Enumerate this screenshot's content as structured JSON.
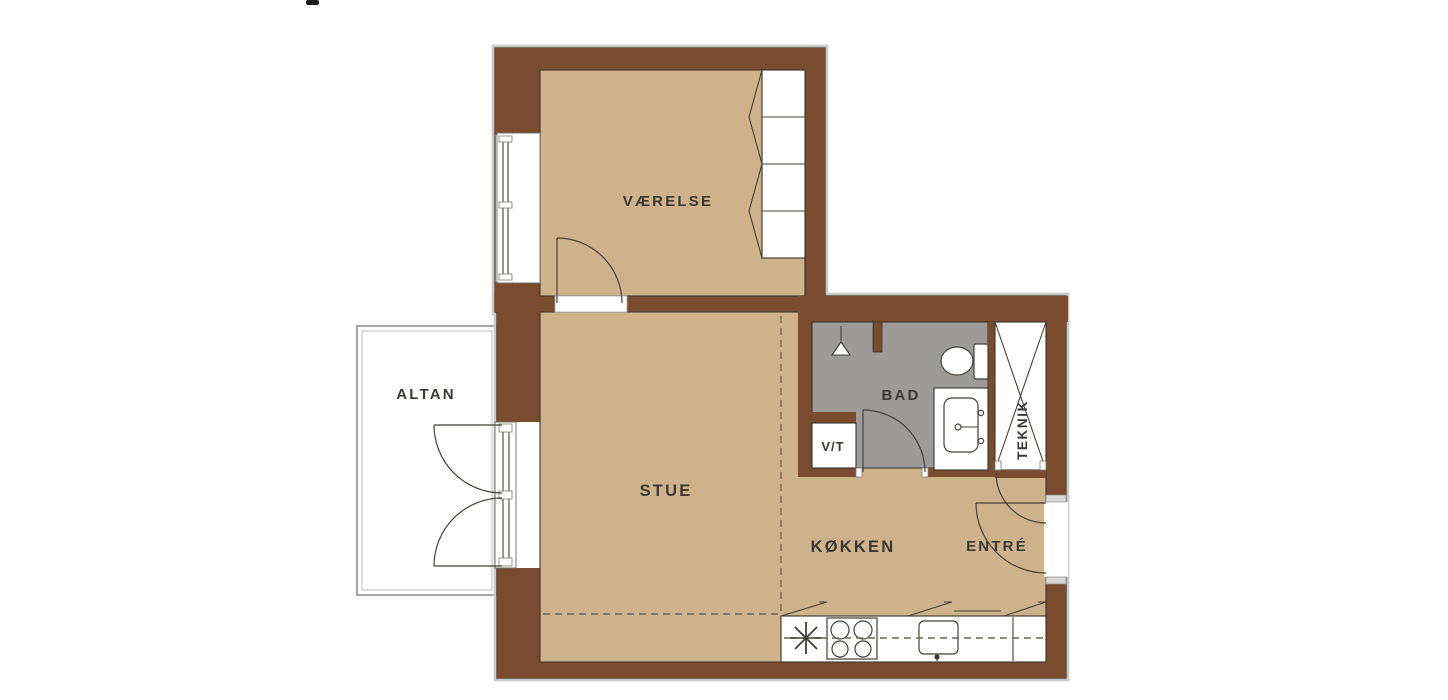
{
  "plan": {
    "type": "apartment-floor-plan",
    "rooms": {
      "vaerelse": "VÆRELSE",
      "altan": "ALTAN",
      "stue": "STUE",
      "bad": "BAD",
      "vt": "V/T",
      "teknik": "TEKNIK",
      "koekken": "KØKKEN",
      "entre": "ENTRÉ"
    },
    "fixtures": [
      "wardrobe",
      "window",
      "balcony-double-door",
      "shower",
      "toilet",
      "sink-vanity",
      "tall-cabinet",
      "kitchen-counter",
      "stove",
      "kitchen-sink",
      "entry-door"
    ],
    "colors": {
      "floor": "#cdb28c",
      "wall": "#7a4c2f",
      "bath_floor": "#9d9b9a",
      "outline": "#3a332a",
      "label": "#3c3833",
      "line": "#45403a",
      "dash": "#6b675f",
      "halo": "#c9c9c9",
      "jamb": "#d8d8d8",
      "balcony_border": "#8f8f8f"
    }
  }
}
